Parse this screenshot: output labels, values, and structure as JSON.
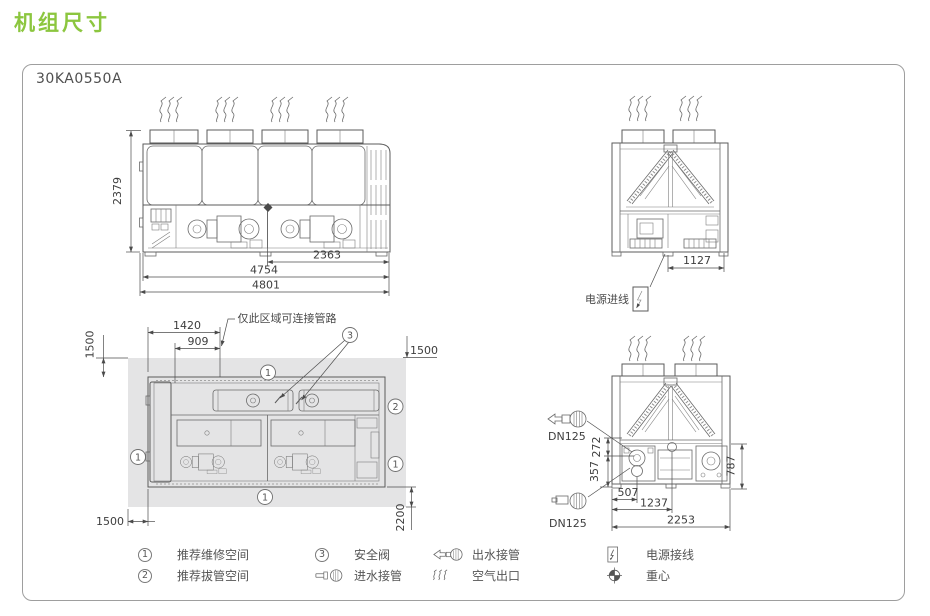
{
  "page": {
    "title": "机组尺寸",
    "model": "30KA0550A"
  },
  "colors": {
    "accent_green": "#8cc63f",
    "unit_fill": "#f2f4de",
    "service_area_gray": "#e4e4e5",
    "line_gray": "#5b5b5b",
    "dim_text": "#3d3d3d"
  },
  "callouts": {
    "c1": "1",
    "c2": "2",
    "c3": "3"
  },
  "views": {
    "front": {
      "dims": {
        "height": "2379",
        "width_right": "2363",
        "width_inner": "4754",
        "width_overall": "4801"
      }
    },
    "end_top": {
      "dims": {
        "electrical_width": "1127"
      },
      "power_inlet_label": "电源进线"
    },
    "plan": {
      "note": "仅此区域可连接管路",
      "dims": {
        "pipe_zone_wide": "1420",
        "pipe_zone_narrow": "909",
        "clearance_top_left": "1500",
        "clearance_top_right": "1500",
        "clearance_bottom_left": "1500",
        "clearance_bottom_right": "2200"
      }
    },
    "end_bottom": {
      "outlet_dn": "DN125",
      "inlet_dn": "DN125",
      "dims": {
        "outlet_height": "272",
        "inlet_height": "357",
        "panel_height": "787",
        "outlet_offset": "507",
        "inlet_offset": "1237",
        "width_overall": "2253"
      }
    }
  },
  "legend": {
    "items": [
      {
        "num": "1",
        "label": "推荐维修空间"
      },
      {
        "num": "3",
        "label": "安全阀"
      },
      {
        "icon": "water-outlet",
        "label": "出水接管"
      },
      {
        "icon": "power-wiring",
        "label": "电源接线"
      },
      {
        "num": "2",
        "label": "推荐拔管空间"
      },
      {
        "icon": "water-inlet",
        "label": "进水接管"
      },
      {
        "icon": "air-outlet",
        "label": "空气出口"
      },
      {
        "icon": "center-of-gravity",
        "label": "重心"
      }
    ]
  }
}
